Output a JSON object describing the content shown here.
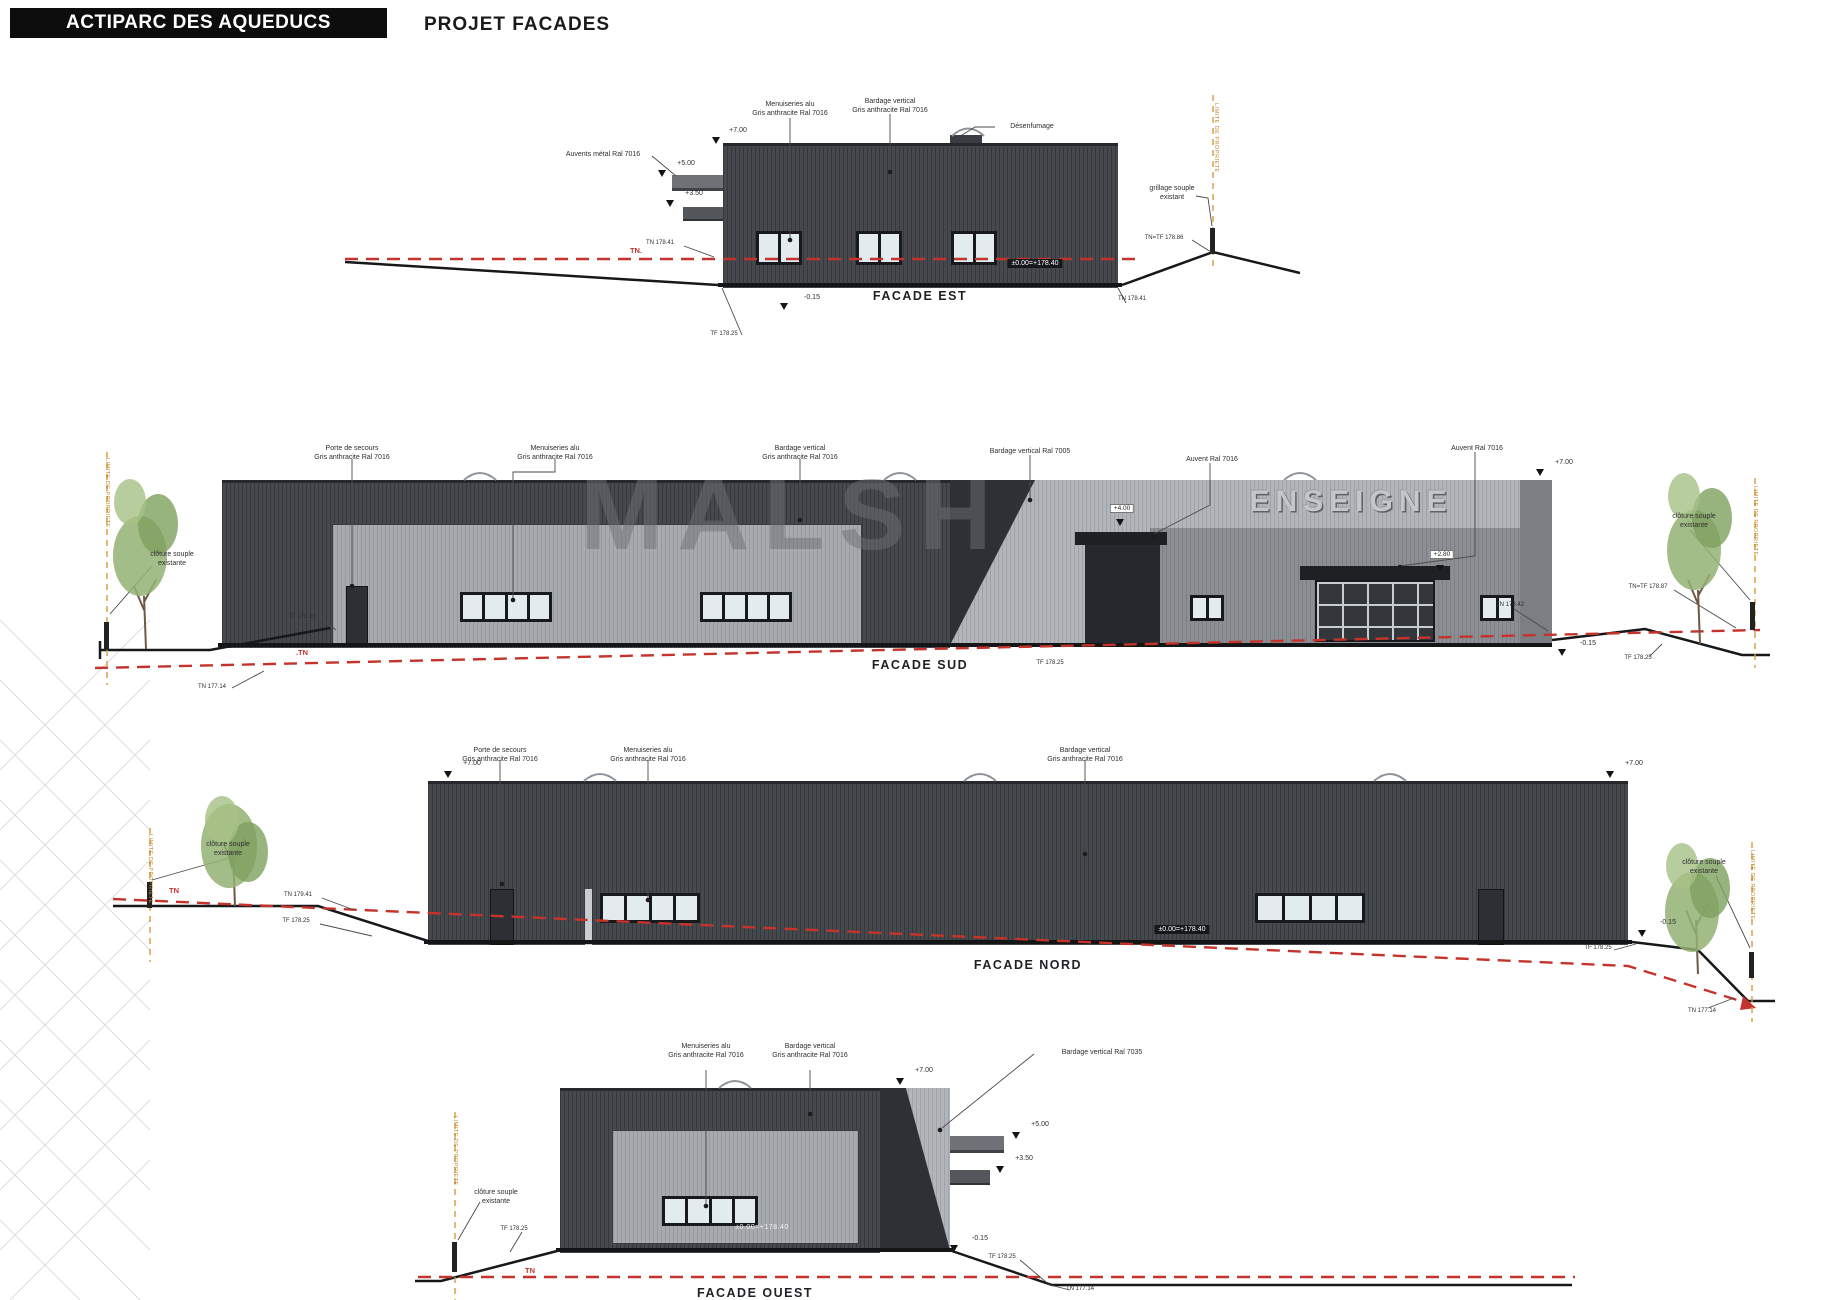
{
  "header": {
    "title": "ACTIPARC DES AQUEDUCS",
    "subtitle": "PROJET FACADES"
  },
  "watermark": "MALSH",
  "colors": {
    "wall_dark": "#45484d",
    "panel_light": "#a7aaae",
    "panel_7005": "#b2b5b9",
    "terrain_line_red": "#c4342c",
    "property_line_orange": "#d99a3c"
  },
  "facades": {
    "est": {
      "caption": "FACADE EST",
      "labels": {
        "menuiseries_1": "Menuiseries alu",
        "menuiseries_2": "Gris anthracite Ral 7016",
        "bardage_1": "Bardage vertical",
        "bardage_2": "Gris anthracite Ral 7016",
        "auvents": "Auvents métal Ral 7016",
        "desenfumage": "Désenfumage",
        "grillage_1": "grillage souple",
        "grillage_2": "existant",
        "tn_tf_right": "TN=TF 178.86",
        "tn_left": "TN 178.41",
        "tn_right": "TN 178.41",
        "tf_left": "TF 178.25",
        "tn_line": "TN.",
        "minus_015": "-0.15",
        "lvl_700": "+7.00",
        "lvl_500": "+5.00",
        "lvl_350": "+3.50",
        "badge": "±0.00=+178.40",
        "limite": "LIMITE DE PROPRIETE"
      }
    },
    "sud": {
      "caption": "FACADE SUD",
      "labels": {
        "porte_1": "Porte de secours",
        "porte_2": "Gris anthracite Ral 7016",
        "menu_1": "Menuiseries alu",
        "menu_2": "Gris anthracite Ral 7016",
        "bardage_1": "Bardage vertical",
        "bardage_2": "Gris anthracite Ral 7016",
        "bardage_7005": "Bardage vertical Ral 7005",
        "auvent_a": "Auvent Ral 7016",
        "auvent_b": "Auvent Ral 7016",
        "lvl_700": "+7.00",
        "enseigne": "ENSEIGNE",
        "badge_quai": "+4.00",
        "badge_entree": "+2.80",
        "cloture_l1": "clôture souple",
        "cloture_l2": "existante",
        "cloture_r1": "clôture souple",
        "cloture_r2": "existante",
        "tf_left": "TF 178.25",
        "tn_bottom": "TN 177.14",
        "tn_line": ".TN",
        "tn_right": "TN 178.42",
        "tn_tf_right": "TN=TF 178.87",
        "minus_015": "-0.15",
        "tf_right": "TF 178.25",
        "tf_caption": "TF 178.25",
        "limite_l": "LIMITE DE PROPRIETE",
        "limite_r": "LIMITE DE PROPRIETE"
      }
    },
    "nord": {
      "caption": "FACADE NORD",
      "labels": {
        "porte_1": "Porte de secours",
        "porte_2": "Gris anthracite Ral 7016",
        "menu_1": "Menuiseries alu",
        "menu_2": "Gris anthracite Ral 7016",
        "bardage_1": "Bardage vertical",
        "bardage_2": "Gris anthracite Ral 7016",
        "lvl_700_l": "+7.00",
        "lvl_700_r": "+7.00",
        "cloture_l1": "clôture souple",
        "cloture_l2": "existante",
        "cloture_r1": "clôture souple",
        "cloture_r2": "existante",
        "tn_left": "TN 179.41",
        "tf_left": "TF 178.25",
        "tn_line": "TN",
        "badge": "±0.00=+178.40",
        "tf_right": "TF 178.25",
        "minus_015": "-0.15",
        "tn_right": "TN 177.14",
        "limite_l": "LIMITE DE PROPRIETE",
        "limite_r": "LIMITE DE PROPRIETE"
      }
    },
    "ouest": {
      "caption": "FACADE OUEST",
      "labels": {
        "menu_1": "Menuiseries alu",
        "menu_2": "Gris anthracite Ral 7016",
        "bardage_1": "Bardage vertical",
        "bardage_2": "Gris anthracite Ral 7016",
        "bardage_7035": "Bardage vertical Ral 7035",
        "lvl_700": "+7.00",
        "lvl_500": "+5.00",
        "lvl_350": "+3.50",
        "badge": "±0.00=+178.40",
        "cloture_1": "clôture souple",
        "cloture_2": "existante",
        "tf_left": "TF 178.25",
        "tn_line": "TN",
        "tf_right": "TF 178.25",
        "minus_015": "-0.15",
        "tn_right": "TN 177.14",
        "limite": "LIMITE DE PROPRIETE"
      }
    }
  }
}
